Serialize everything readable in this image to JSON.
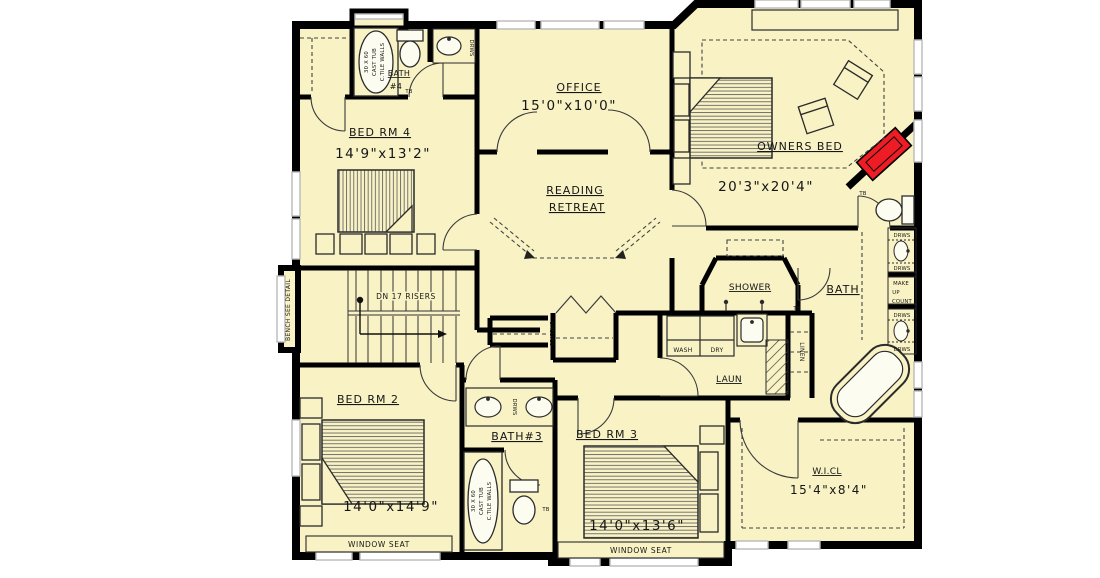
{
  "colors": {
    "floor": "#f8f2c4",
    "wall": "#000000",
    "window_gray": "#b9b9b9",
    "fireplace_red": "#ee1c24",
    "thin_line": "#2b2b2b"
  },
  "rooms": {
    "bedrm4": {
      "label": "BED RM 4",
      "dims": "14'9\"x13'2\""
    },
    "office": {
      "label": "OFFICE",
      "dims": "15'0\"x10'0\""
    },
    "reading": {
      "line1": "READING",
      "line2": "RETREAT"
    },
    "owners": {
      "label": "OWNERS BED",
      "dims": "20'3\"x20'4\""
    },
    "bath4": {
      "line1": "BATH",
      "line2": "#4"
    },
    "master_bath": {
      "label": "BATH"
    },
    "shower": {
      "label": "SHOWER"
    },
    "laundry": {
      "label": "LAUN"
    },
    "bedrm2": {
      "label": "BED RM 2",
      "dims": "14'0\"x14'9\""
    },
    "bath3": {
      "label": "BATH#3"
    },
    "bedrm3": {
      "label": "BED RM 3",
      "dims": "14'0\"x13'6\""
    },
    "wicl": {
      "label": "W.I.CL",
      "dims": "15'4\"x8'4\""
    }
  },
  "annotations": {
    "stairs": "DN 17 RISERS",
    "bench": "BENCH SEE DETAIL",
    "window_seat": "WINDOW SEAT",
    "wash": "WASH",
    "dry": "DRY",
    "linen": "LINEN",
    "shelves": "SHELVES",
    "drws": "DRWS",
    "makeup": [
      "MAKE",
      "UP",
      "COUNT"
    ],
    "cast_tub": [
      "30 X 60",
      "CAST TUB",
      "C.TILE WALLS"
    ],
    "tb": "TB"
  }
}
